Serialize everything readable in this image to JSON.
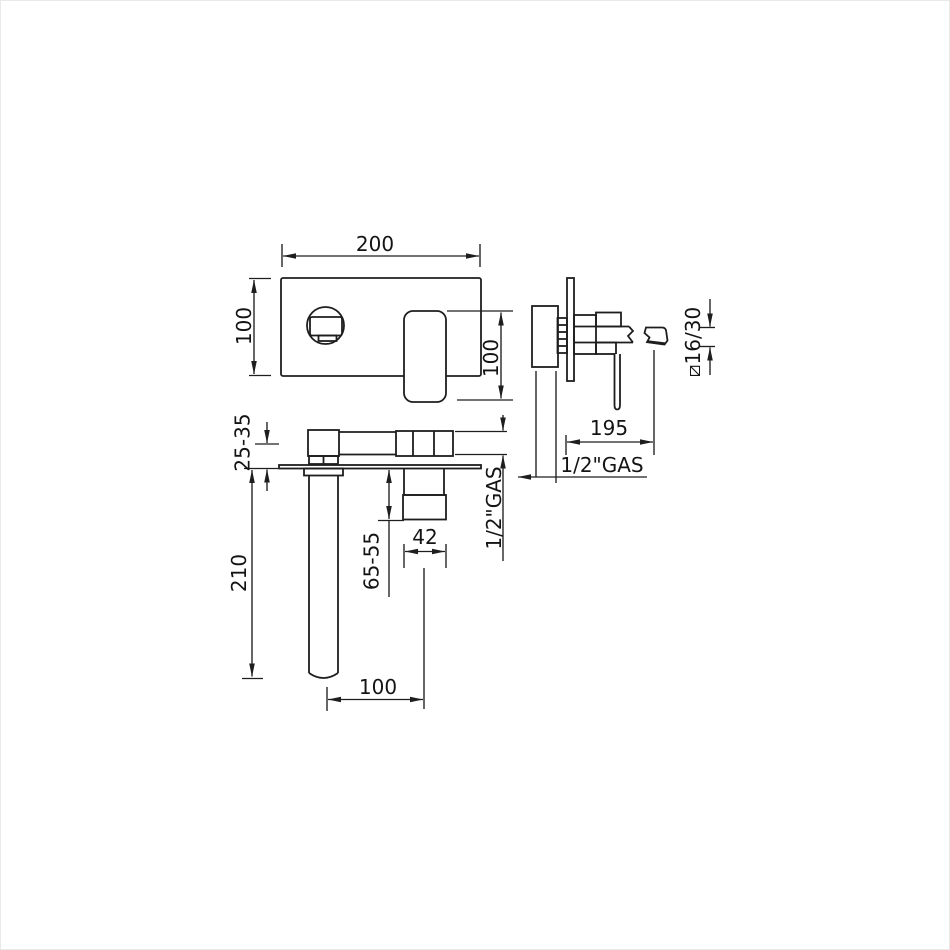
{
  "drawing": {
    "kind": "technical-installation-drawing",
    "colors": {
      "line": "#1e1e1e",
      "background": "#ffffff"
    }
  },
  "labels": {
    "plate_width": "200",
    "plate_height": "100",
    "handle_length": "100",
    "spout_section": "⧄16/30",
    "spout_reach": "195",
    "gas_side": "1/2\"GAS",
    "wall_depth_range": "25-35",
    "spout_projection": "210",
    "handle_projection_range": "65-55",
    "handle_width": "42",
    "spout_to_handle": "100",
    "gas_bottom": "1/2\"GAS"
  }
}
